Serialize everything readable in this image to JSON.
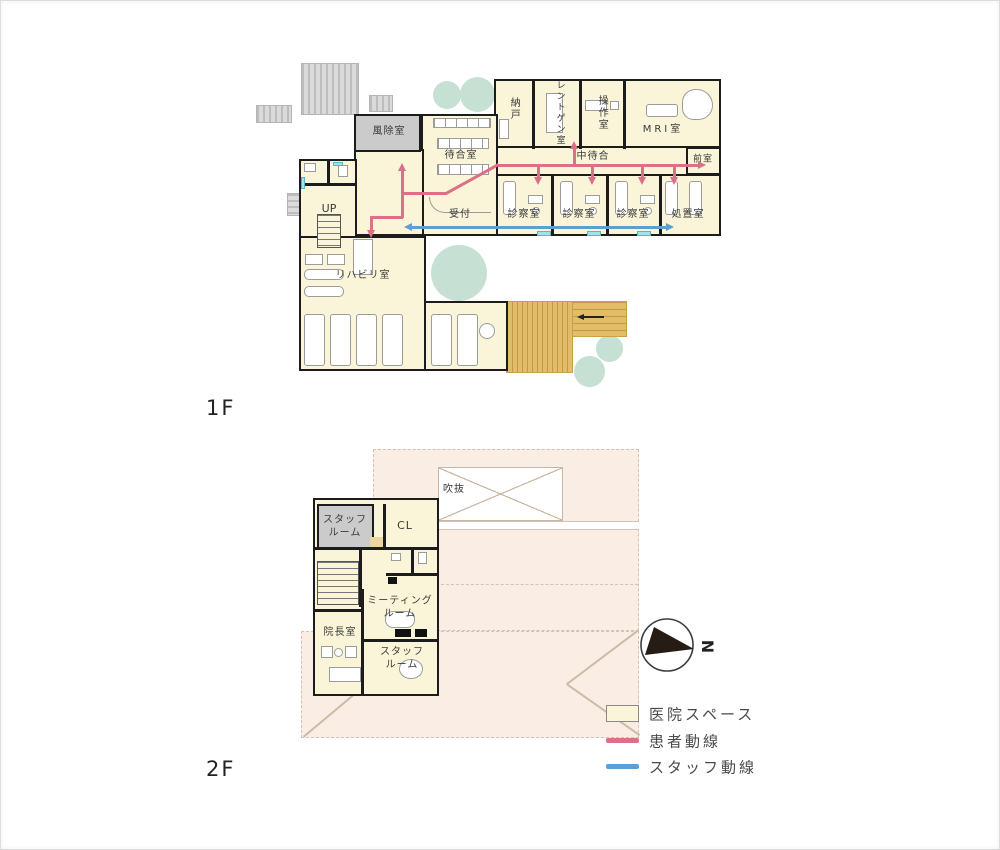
{
  "floors": [
    {
      "label": "1F",
      "rooms": {
        "windbreak": "風除室",
        "waiting": "待合室",
        "storage": "納戸",
        "xray": "レントゲン室",
        "control": "操作室",
        "mri": "MRI室",
        "mid_waiting": "中待合",
        "anteroom": "前室",
        "stairs_up": "UP",
        "reception": "受付",
        "exam": "診察室",
        "treatment": "処置室",
        "rehab": "リハビリ室"
      }
    },
    {
      "label": "2F",
      "rooms": {
        "staff_room_a": [
          "スタッフ",
          "ルーム"
        ],
        "closet": "CL",
        "void": "吹抜",
        "meeting_room": [
          "ミーティング",
          "ルーム"
        ],
        "director_room": "院長室",
        "staff_room_b": [
          "スタッフ",
          "ルーム"
        ]
      }
    }
  ],
  "legend": {
    "items": [
      {
        "id": "clinic-space",
        "label": "医院スペース",
        "swatch": "area",
        "color": "#FAF5D8"
      },
      {
        "id": "patient-flow",
        "label": "患者動線",
        "swatch": "line",
        "color": "#DC7089"
      },
      {
        "id": "staff-flow",
        "label": "スタッフ動線",
        "swatch": "line",
        "color": "#5B9FD4"
      }
    ]
  },
  "compass": {
    "north_label": "N"
  },
  "colors": {
    "clinic_fill": "#FAF5D8",
    "wall": "#1c1c1c",
    "patient_flow": "#DC7089",
    "staff_flow": "#5B9FD4",
    "deck": "#E3BC68",
    "tree": "#C6E0D4",
    "roof": "#F9EDE4",
    "gray_area": "#CBCBCB"
  }
}
